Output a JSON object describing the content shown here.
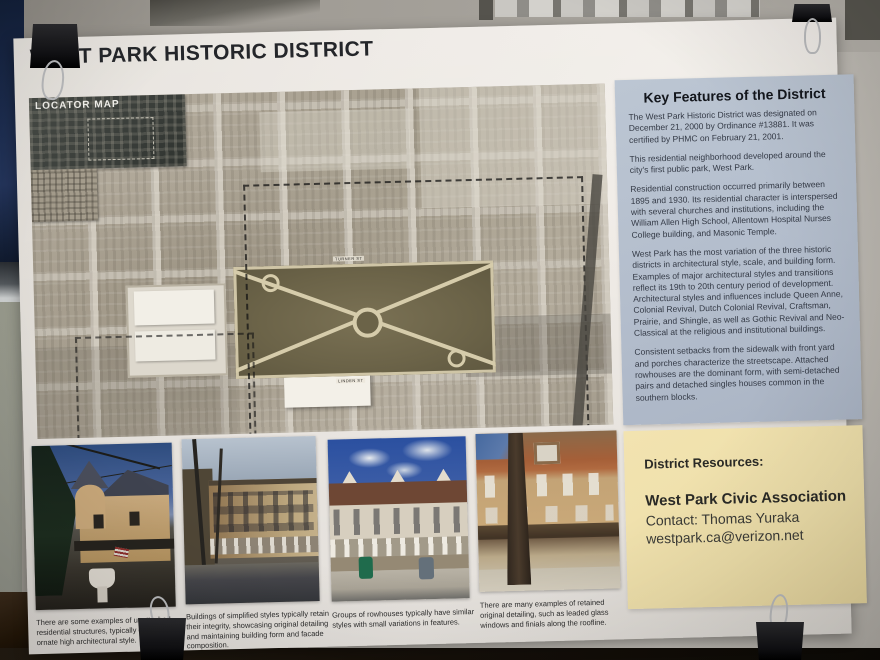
{
  "poster": {
    "title": "WEST PARK HISTORIC DISTRICT",
    "map": {
      "locator_label": "LOCATOR MAP",
      "street_labels": [
        "TURNER ST",
        "LINDEN ST"
      ]
    },
    "key_features": {
      "heading": "Key Features of the District",
      "paragraphs": [
        "The West Park Historic District was designated on December 21, 2000 by Ordinance #13881. It was certified by PHMC on February 21, 2001.",
        "This residential neighborhood developed around the city's first public park, West Park.",
        "Residential construction occurred primarily between 1895 and 1930. Its residential character is interspersed with several churches and institutions, including the William Allen High School, Allentown Hospital Nurses College building, and Masonic Temple.",
        "West Park has the most variation of the three historic districts in architectural style, scale, and building form. Examples of major architectural styles and transitions reflect its 19th to 20th century period of development. Architectural styles and influences include Queen Anne, Colonial Revival, Dutch Colonial Revival, Craftsman, Prairie, and Shingle, as well as Gothic Revival and Neo-Classical at the religious and institutional buildings.",
        "Consistent setbacks from the sidewalk with front yard and porches characterize the streetscape. Attached rowhouses are the dominant form, with semi-detached pairs and detached singles houses common in the southern blocks."
      ]
    },
    "photo_captions": [
      "There are some examples of unattached residential structures, typically of a more ornate high architectural style.",
      "Buildings of simplified styles typically retain their integrity, showcasing original detailing and maintaining building form and facade composition.",
      "Groups of rowhouses typically have similar styles with small variations in features.",
      "There are many examples of retained original detailing, such as leaded glass windows and finials along the roofline."
    ],
    "resources": {
      "heading": "District Resources:",
      "organization": "West Park Civic Association",
      "contact": "Contact: Thomas Yuraka",
      "email": "westpark.ca@verizon.net"
    },
    "colors": {
      "panel_blue": "#b6c0ce",
      "panel_yellow": "#eedfaa",
      "poster_paper": "#ebe7e2",
      "park_green": "#6b6348"
    }
  }
}
